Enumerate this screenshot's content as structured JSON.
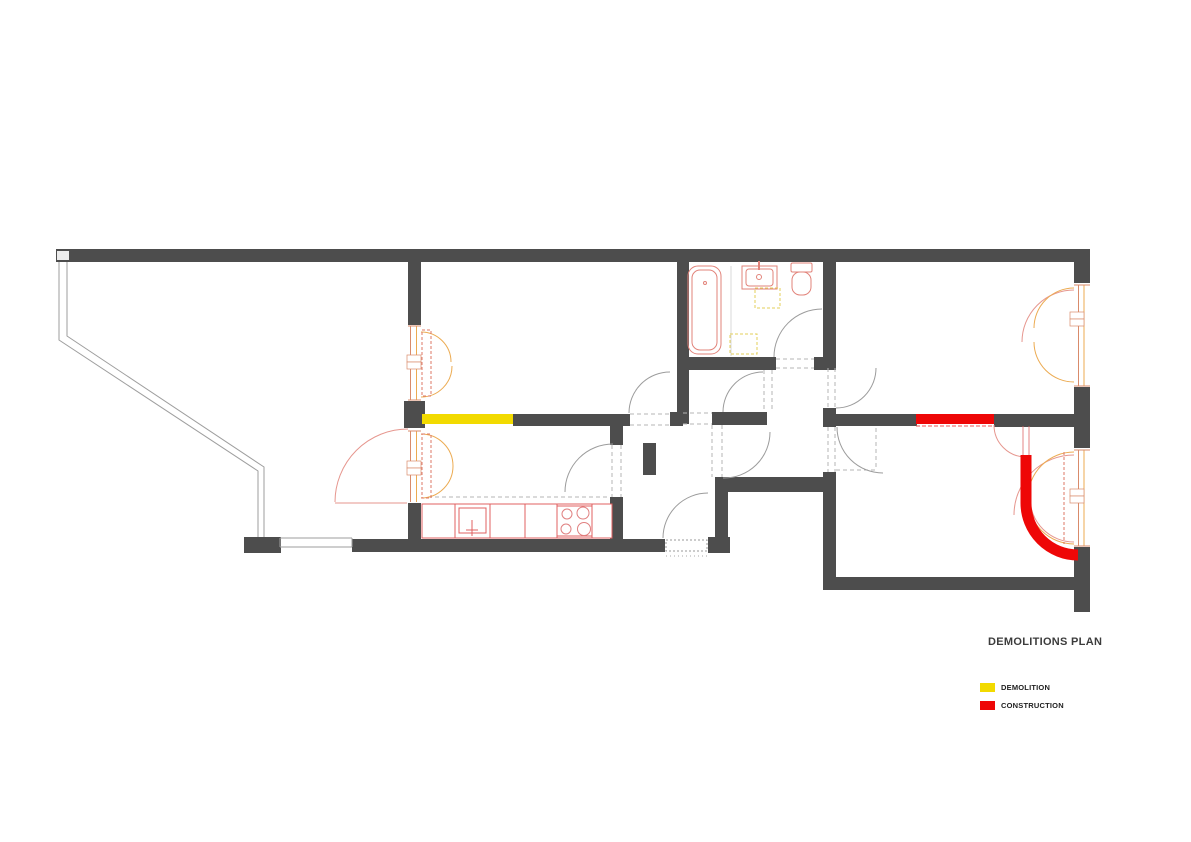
{
  "title": "DEMOLITIONS PLAN",
  "legend": {
    "items": [
      {
        "label": "DEMOLITION",
        "color": "#f2da00"
      },
      {
        "label": "CONSTRUCTION",
        "color": "#ee0707"
      }
    ]
  },
  "colors": {
    "demolition": "#f2da00",
    "construction": "#ee0707",
    "wall": "#4d4d4d",
    "fixture_red": "#e06060",
    "window_orange": "#ecab52"
  }
}
